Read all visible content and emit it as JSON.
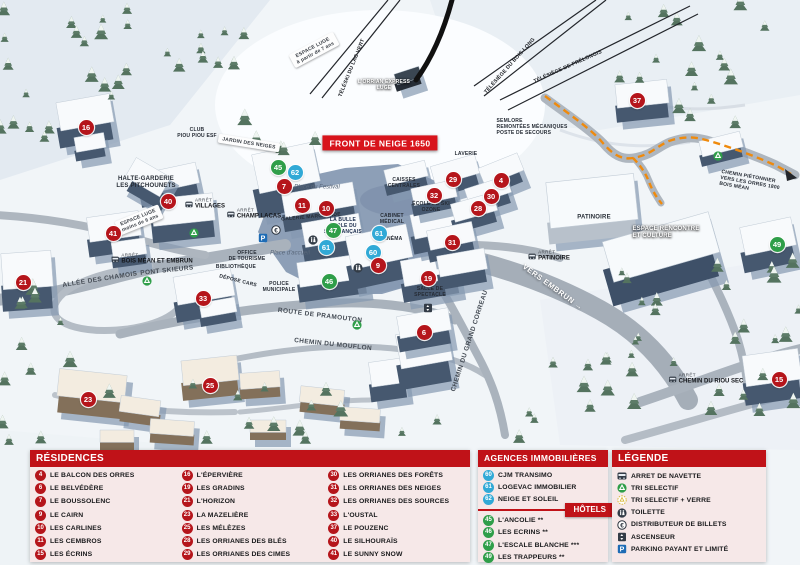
{
  "colors": {
    "red": "#b5151b",
    "blue": "#31a9d6",
    "green": "#2f9e49",
    "header_red": "#c01218",
    "banner_red": "#d8141c",
    "panel_pink": "#f6e8e8",
    "path_orange": "#ef8a0d"
  },
  "map": {
    "labels": [
      {
        "text": "ESPACE LUGE\nà partir de 7 ans",
        "x": 314,
        "y": 50,
        "r": -28,
        "cls": "sign"
      },
      {
        "text": "TÉLÉSKI DU LAC VERT",
        "x": 352,
        "y": 68,
        "r": -68,
        "cls": "lift"
      },
      {
        "text": "L'ORRIAN EXPRESS\nLUGE",
        "x": 384,
        "y": 85,
        "r": 0,
        "cls": "white tiny"
      },
      {
        "text": "TÉLÉSIÈGE DU BOIS LONG",
        "x": 510,
        "y": 66,
        "r": -48,
        "cls": "lift"
      },
      {
        "text": "TÉLÉSIÈGE DE PRÉLONGIS",
        "x": 568,
        "y": 67,
        "r": -24,
        "cls": "lift"
      },
      {
        "text": "SEMLORE\nREMONTÉES MÉCANIQUES\nPOSTE DE SECOURS",
        "x": 532,
        "y": 127,
        "r": 0,
        "cls": "poi-left tiny"
      },
      {
        "text": "FRONT DE NEIGE 1650",
        "x": 380,
        "y": 143,
        "r": 0,
        "cls": "banner"
      },
      {
        "text": "CLUB\nPIOU PIOU ESF",
        "x": 197,
        "y": 133,
        "r": 0,
        "cls": "tiny"
      },
      {
        "text": "JARDIN DES NEIGES",
        "x": 249,
        "y": 143,
        "r": 9,
        "cls": "sign"
      },
      {
        "text": "HALTE-GARDERIE\nLES PITCHOUNETS",
        "x": 146,
        "y": 183,
        "r": 0,
        "cls": ""
      },
      {
        "text": "ESPACE LUGE\nmoins de 6 ans",
        "x": 139,
        "y": 220,
        "r": -22,
        "cls": "sign"
      },
      {
        "text": "LA BULLE\nÉCOLE DU\nSKI FRANÇAIS",
        "x": 343,
        "y": 226,
        "r": 0,
        "cls": "navy tiny"
      },
      {
        "text": "Place du Festival",
        "x": 317,
        "y": 188,
        "r": 0,
        "cls": "place"
      },
      {
        "text": "Place d'accueil",
        "x": 290,
        "y": 254,
        "r": 0,
        "cls": "place"
      },
      {
        "text": "CAISSES\nCENTRALES",
        "x": 404,
        "y": 183,
        "r": 0,
        "cls": "tiny"
      },
      {
        "text": "CABINET\nMÉDICAL",
        "x": 392,
        "y": 219,
        "r": 0,
        "cls": "tiny"
      },
      {
        "text": "CINÉMA",
        "x": 392,
        "y": 239,
        "r": 0,
        "cls": "tiny"
      },
      {
        "text": "GALERIE MARCHANDE",
        "x": 311,
        "y": 217,
        "r": -5,
        "cls": "tiny"
      },
      {
        "text": "ÉCOLE DE SKI\nOZONE",
        "x": 431,
        "y": 207,
        "r": 0,
        "cls": "tiny"
      },
      {
        "text": "LAVERIE",
        "x": 466,
        "y": 154,
        "r": 0,
        "cls": "tiny"
      },
      {
        "text": "PATINOIRE",
        "x": 594,
        "y": 218,
        "r": 0,
        "cls": ""
      },
      {
        "text": "ESPACE RENCONTRE\nET CULTURE",
        "x": 666,
        "y": 233,
        "r": 0,
        "cls": "white poi-left"
      },
      {
        "text": "VERS EMBRUN →",
        "x": 553,
        "y": 287,
        "r": 36,
        "cls": "dir"
      },
      {
        "text": "CHEMIN PIÉTONNIER\nVERS LES ORRES 1800\nBOIS MÉAN",
        "x": 750,
        "y": 183,
        "r": 10,
        "cls": "poi-left tiny"
      },
      {
        "text": "ALLÉE DES CHAMOIS",
        "x": 100,
        "y": 280,
        "r": -9,
        "cls": "road"
      },
      {
        "text": "PONT SKIEURS",
        "x": 167,
        "y": 271,
        "r": -6,
        "cls": "road"
      },
      {
        "text": "ROUTE DE PRAMOUTON",
        "x": 320,
        "y": 316,
        "r": 7,
        "cls": "road"
      },
      {
        "text": "CHEMIN DU MOUFLON",
        "x": 333,
        "y": 345,
        "r": 6,
        "cls": "road"
      },
      {
        "text": "CHEMIN DU GRAND CORREAU",
        "x": 470,
        "y": 341,
        "r": -72,
        "cls": "road"
      },
      {
        "text": "OFFICE\nDE TOURISME",
        "x": 247,
        "y": 256,
        "r": 0,
        "cls": "tiny"
      },
      {
        "text": "BIBLIOTHÈQUE",
        "x": 236,
        "y": 267,
        "r": 0,
        "cls": "tiny"
      },
      {
        "text": "POLICE\nMUNICIPALE",
        "x": 279,
        "y": 287,
        "r": 0,
        "cls": "tiny"
      },
      {
        "text": "DÉPOSE CARS",
        "x": 238,
        "y": 281,
        "r": 14,
        "cls": "tiny"
      },
      {
        "text": "SALLE DE\nSPECTACLE",
        "x": 430,
        "y": 292,
        "r": 0,
        "cls": "tiny"
      }
    ],
    "bus_stops": {
      "prefix": "ARRÊT",
      "stops": [
        {
          "name": "VILLAGES",
          "x": 205,
          "y": 204
        },
        {
          "name": "CHAMP LACAS",
          "x": 254,
          "y": 214
        },
        {
          "name": "BOIS MÉAN ET EMBRUN",
          "x": 152,
          "y": 259
        },
        {
          "name": "PATINOIRE",
          "x": 549,
          "y": 256
        },
        {
          "name": "CHEMIN DU RIOU SEC",
          "x": 706,
          "y": 379
        }
      ]
    },
    "markers": [
      {
        "n": "16",
        "t": "r",
        "x": 86,
        "y": 127
      },
      {
        "n": "40",
        "t": "r",
        "x": 168,
        "y": 201
      },
      {
        "n": "41",
        "t": "r",
        "x": 113,
        "y": 233
      },
      {
        "n": "21",
        "t": "r",
        "x": 23,
        "y": 282
      },
      {
        "n": "33",
        "t": "r",
        "x": 203,
        "y": 298
      },
      {
        "n": "23",
        "t": "r",
        "x": 88,
        "y": 399
      },
      {
        "n": "25",
        "t": "r",
        "x": 210,
        "y": 385
      },
      {
        "n": "45",
        "t": "g",
        "x": 278,
        "y": 167
      },
      {
        "n": "62",
        "t": "b",
        "x": 295,
        "y": 172
      },
      {
        "n": "7",
        "t": "r",
        "x": 284,
        "y": 186
      },
      {
        "n": "11",
        "t": "r",
        "x": 302,
        "y": 205
      },
      {
        "n": "10",
        "t": "r",
        "x": 326,
        "y": 208
      },
      {
        "n": "47",
        "t": "g",
        "x": 333,
        "y": 230
      },
      {
        "n": "61",
        "t": "b",
        "x": 379,
        "y": 233
      },
      {
        "n": "61",
        "t": "b",
        "x": 326,
        "y": 247
      },
      {
        "n": "60",
        "t": "b",
        "x": 373,
        "y": 252
      },
      {
        "n": "9",
        "t": "r",
        "x": 378,
        "y": 265
      },
      {
        "n": "46",
        "t": "g",
        "x": 329,
        "y": 281
      },
      {
        "n": "19",
        "t": "r",
        "x": 428,
        "y": 278
      },
      {
        "n": "6",
        "t": "r",
        "x": 424,
        "y": 332
      },
      {
        "n": "29",
        "t": "r",
        "x": 453,
        "y": 179
      },
      {
        "n": "4",
        "t": "r",
        "x": 501,
        "y": 180
      },
      {
        "n": "32",
        "t": "r",
        "x": 434,
        "y": 195
      },
      {
        "n": "30",
        "t": "r",
        "x": 491,
        "y": 196
      },
      {
        "n": "28",
        "t": "r",
        "x": 478,
        "y": 208
      },
      {
        "n": "31",
        "t": "r",
        "x": 452,
        "y": 242
      },
      {
        "n": "37",
        "t": "r",
        "x": 637,
        "y": 100
      },
      {
        "n": "49",
        "t": "g",
        "x": 777,
        "y": 244
      },
      {
        "n": "15",
        "t": "r",
        "x": 779,
        "y": 379
      }
    ],
    "icons": [
      {
        "icon": "recycle-icon",
        "x": 194,
        "y": 233
      },
      {
        "icon": "recycle-icon",
        "x": 147,
        "y": 281
      },
      {
        "icon": "recycle-icon",
        "x": 357,
        "y": 325
      },
      {
        "icon": "recycle-icon",
        "x": 718,
        "y": 156
      },
      {
        "icon": "toilet-icon",
        "x": 313,
        "y": 240
      },
      {
        "icon": "toilet-icon",
        "x": 358,
        "y": 268
      },
      {
        "icon": "atm-icon",
        "x": 276,
        "y": 230
      },
      {
        "icon": "parking-icon",
        "x": 263,
        "y": 238
      },
      {
        "icon": "elevator-icon",
        "x": 428,
        "y": 308
      }
    ]
  },
  "legend_panels": {
    "residences": {
      "title": "RÉSIDENCES",
      "columns": [
        [
          {
            "n": "4",
            "label": "LE BALCON DES ORRES"
          },
          {
            "n": "6",
            "label": "LE BELVÉDÈRE"
          },
          {
            "n": "7",
            "label": "LE BOUSSOLENC"
          },
          {
            "n": "9",
            "label": "LE CAIRN"
          },
          {
            "n": "10",
            "label": "LES CARLINES"
          },
          {
            "n": "11",
            "label": "LES CEMBROS"
          },
          {
            "n": "15",
            "label": "LES ÉCRINS"
          }
        ],
        [
          {
            "n": "16",
            "label": "L'ÉPERVIÈRE"
          },
          {
            "n": "19",
            "label": "LES GRADINS"
          },
          {
            "n": "21",
            "label": "L'HORIZON"
          },
          {
            "n": "23",
            "label": "LA MAZELIÈRE"
          },
          {
            "n": "25",
            "label": "LES MÉLÈZES"
          },
          {
            "n": "28",
            "label": "LES ORRIANES DES BLÉS"
          },
          {
            "n": "29",
            "label": "LES ORRIANES DES CIMES"
          }
        ],
        [
          {
            "n": "30",
            "label": "LES ORRIANES DES FORÊTS"
          },
          {
            "n": "31",
            "label": "LES ORRIANES DES NEIGES"
          },
          {
            "n": "32",
            "label": "LES ORRIANES DES SOURCES"
          },
          {
            "n": "33",
            "label": "L'OUSTAL"
          },
          {
            "n": "37",
            "label": "LE POUZENC"
          },
          {
            "n": "40",
            "label": "LE SILHOURAÏS"
          },
          {
            "n": "41",
            "label": "LE SUNNY SNOW"
          }
        ]
      ]
    },
    "agences": {
      "title": "AGENCES IMMOBILIÈRES",
      "items": [
        {
          "n": "60",
          "label": "CJM TRANSIMO"
        },
        {
          "n": "61",
          "label": "LOGEVAC IMMOBILIER"
        },
        {
          "n": "62",
          "label": "NEIGE ET SOLEIL"
        }
      ]
    },
    "hotels": {
      "tag": "HÔTELS",
      "items": [
        {
          "n": "45",
          "label": "L'ANCOLIE **"
        },
        {
          "n": "46",
          "label": "LES ECRINS **"
        },
        {
          "n": "47",
          "label": "L'ESCALE BLANCHE ***"
        },
        {
          "n": "49",
          "label": "LES TRAPPEURS **"
        }
      ]
    },
    "legende": {
      "title": "LÉGENDE",
      "items": [
        {
          "icon": "bus-icon",
          "label": "ARRET DE NAVETTE"
        },
        {
          "icon": "recycle-icon",
          "label": "TRI SELECTIF"
        },
        {
          "icon": "recycle-glass-icon",
          "label": "TRI SELECTIF + VERRE"
        },
        {
          "icon": "toilet-icon",
          "label": "TOILETTE"
        },
        {
          "icon": "atm-icon",
          "label": "DISTRIBUTEUR DE BILLETS"
        },
        {
          "icon": "elevator-icon",
          "label": "ASCENSEUR"
        },
        {
          "icon": "parking-icon",
          "label": "PARKING PAYANT ET LIMITÉ"
        }
      ]
    }
  }
}
